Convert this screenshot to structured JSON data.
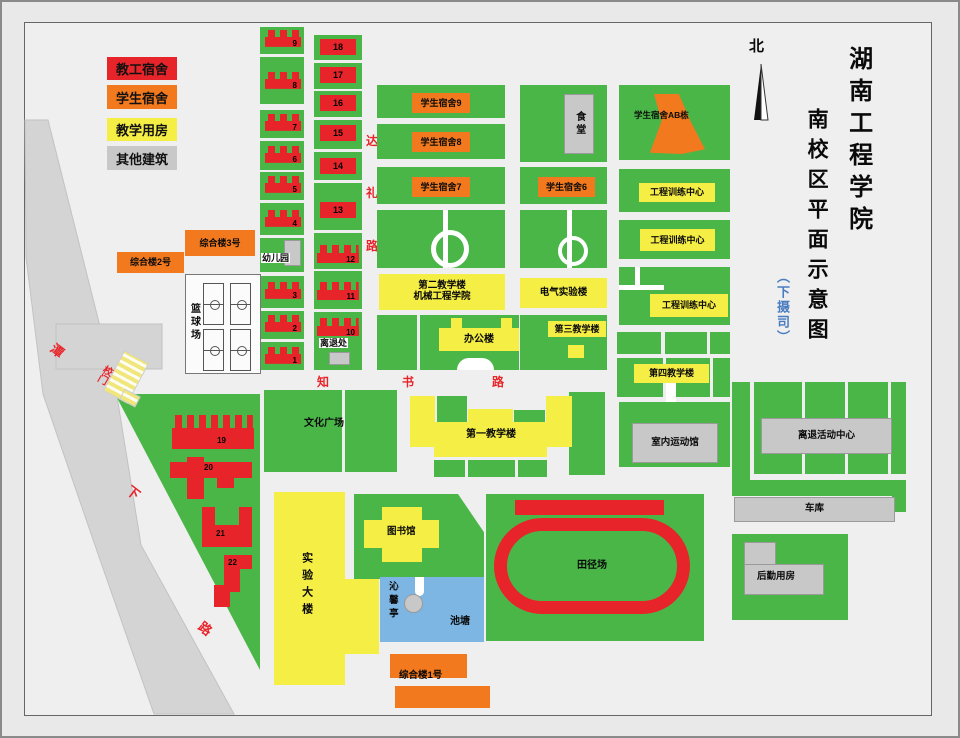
{
  "title": {
    "main": "湖南工程学院",
    "sub": "南校区平面示意图",
    "note": "（下摄司）",
    "north": "北"
  },
  "legend": {
    "items": [
      {
        "label": "教工宿舍",
        "color": "#e72429"
      },
      {
        "label": "学生宿舍",
        "color": "#f2791e"
      },
      {
        "label": "教学用房",
        "color": "#f5ee44"
      },
      {
        "label": "其他建筑",
        "color": "#c8c8c8"
      }
    ]
  },
  "roads": {
    "dali": [
      "达",
      "礼",
      "路"
    ],
    "zhishu": [
      "知",
      "书",
      "路"
    ],
    "tanxia": [
      "潭",
      "下",
      "路"
    ],
    "gate": "校门"
  },
  "labels": {
    "dorm9": "学生宿舍9",
    "dorm8": "学生宿舍8",
    "dorm7": "学生宿舍7",
    "dorm6": "学生宿舍6",
    "dormAB": "学生宿舍AB栋",
    "canteen": "食堂",
    "training": "工程训练中心",
    "teach2a": "第二教学楼",
    "teach2b": "机械工程学院",
    "elec": "电气实验楼",
    "office": "办公楼",
    "teach3": "第三教学楼",
    "teach4": "第四教学楼",
    "teach1": "第一教学楼",
    "culture": "文化广场",
    "kindergarten": "幼儿园",
    "retire_office": "离退处",
    "retire_center": "离退活动中心",
    "indoor": "室内运动馆",
    "garage": "车库",
    "logistics": "后勤用房",
    "lab": "实验大楼",
    "library": "图书馆",
    "pavilion": "沁馨亭",
    "pond": "池塘",
    "track": "田径场",
    "complex1": "综合楼1号",
    "complex2": "综合楼2号",
    "complex3": "综合楼3号",
    "basketball": "篮球场"
  },
  "nums": [
    "1",
    "2",
    "3",
    "4",
    "5",
    "6",
    "7",
    "8",
    "9",
    "10",
    "11",
    "12",
    "13",
    "14",
    "15",
    "16",
    "17",
    "18",
    "19",
    "20",
    "21",
    "22"
  ],
  "colors": {
    "green": "#4ab648",
    "staff_dorm_red": "#e72429",
    "student_dorm_orange": "#f2791e",
    "teaching_yellow": "#f5ee44",
    "other_gray": "#c8c8c8",
    "road_gray": "#d4d4d4",
    "pond_blue": "#7db5e3",
    "road_text_red": "#e8252a",
    "note_blue": "#4a7cc0"
  }
}
